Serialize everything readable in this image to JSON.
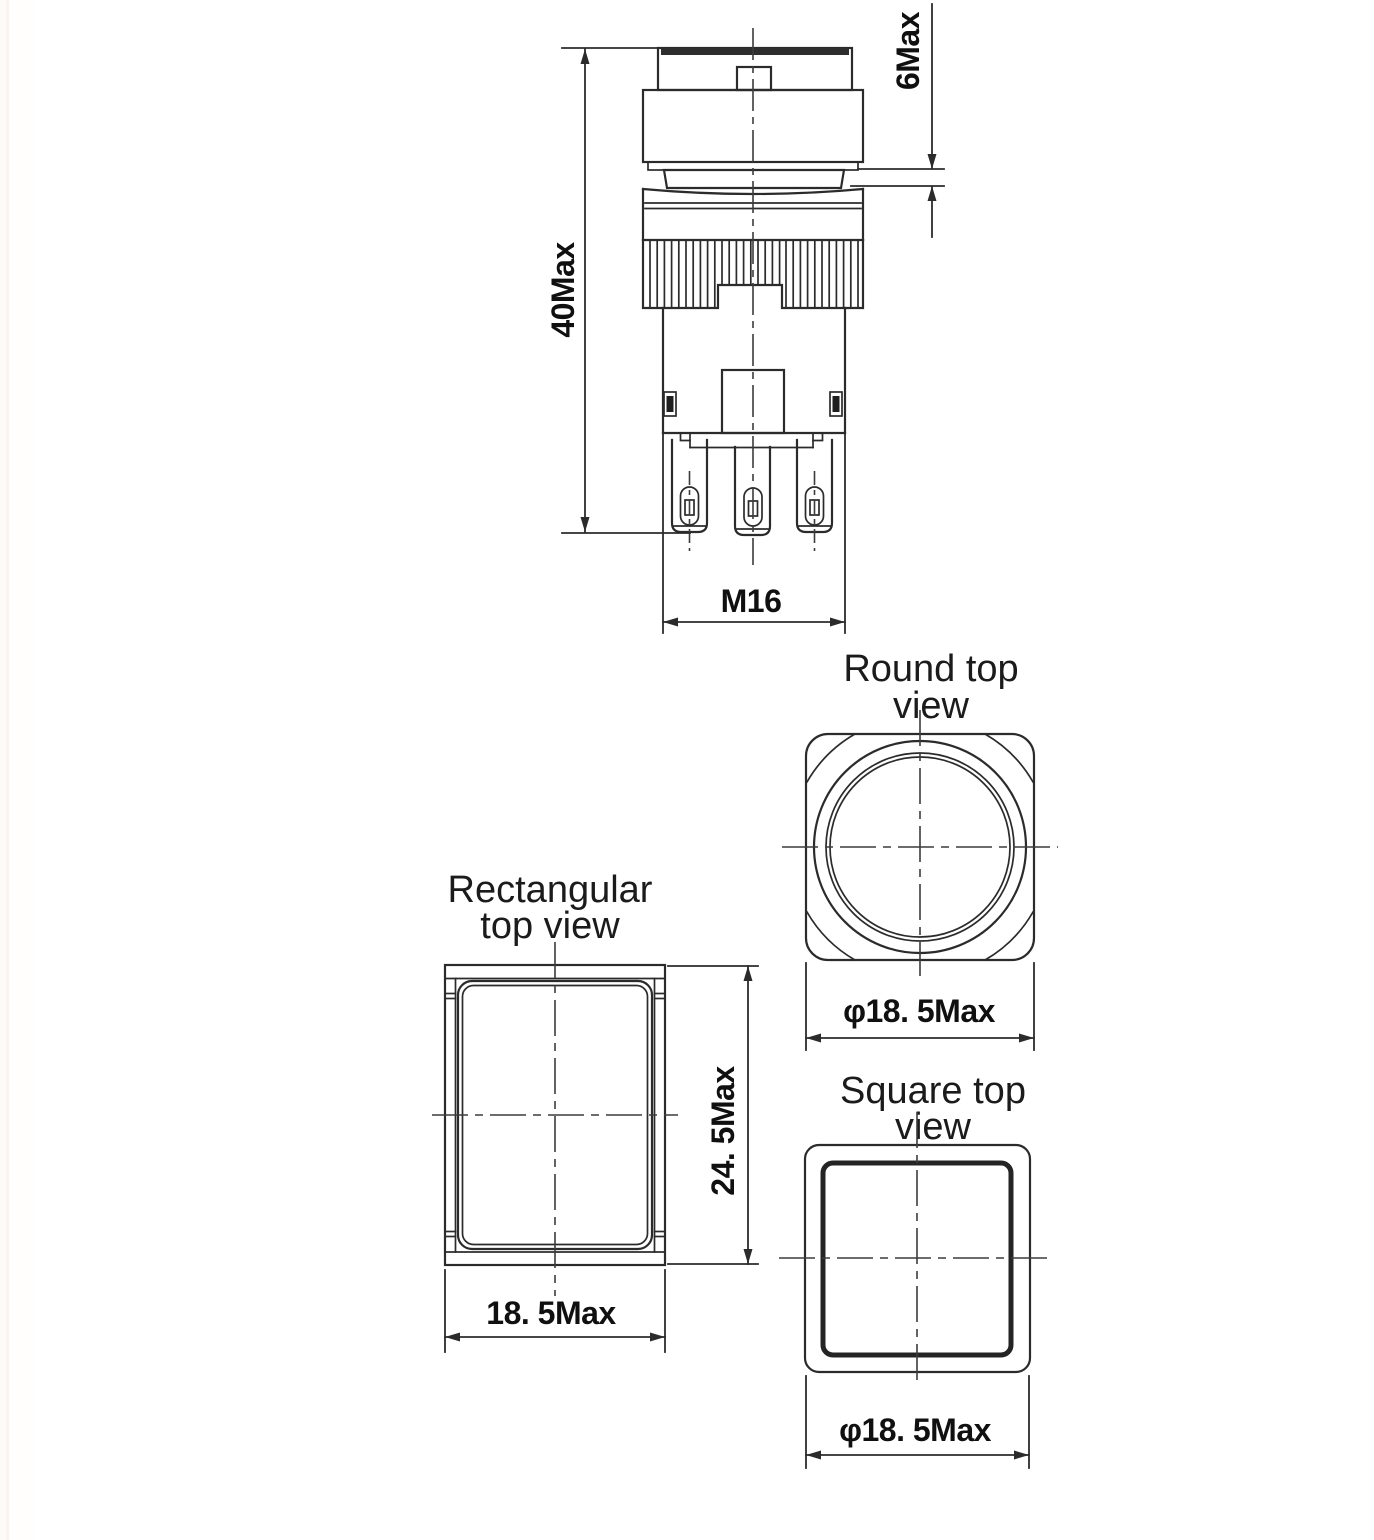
{
  "colors": {
    "line": "#2b2b2b",
    "background": "#ffffff"
  },
  "side_view": {
    "dim_height": "40Max",
    "dim_travel": "6Max",
    "dim_thread": "M16"
  },
  "round_top_view": {
    "title_line1": "Round top",
    "title_line2": "view",
    "dim_diameter": "φ18. 5Max"
  },
  "rectangular_top_view": {
    "title_line1": "Rectangular",
    "title_line2": "top view",
    "dim_height": "24. 5Max",
    "dim_width": "18. 5Max"
  },
  "square_top_view": {
    "title_line1": "Square top",
    "title_line2": "view",
    "dim_diameter": "φ18. 5Max"
  }
}
